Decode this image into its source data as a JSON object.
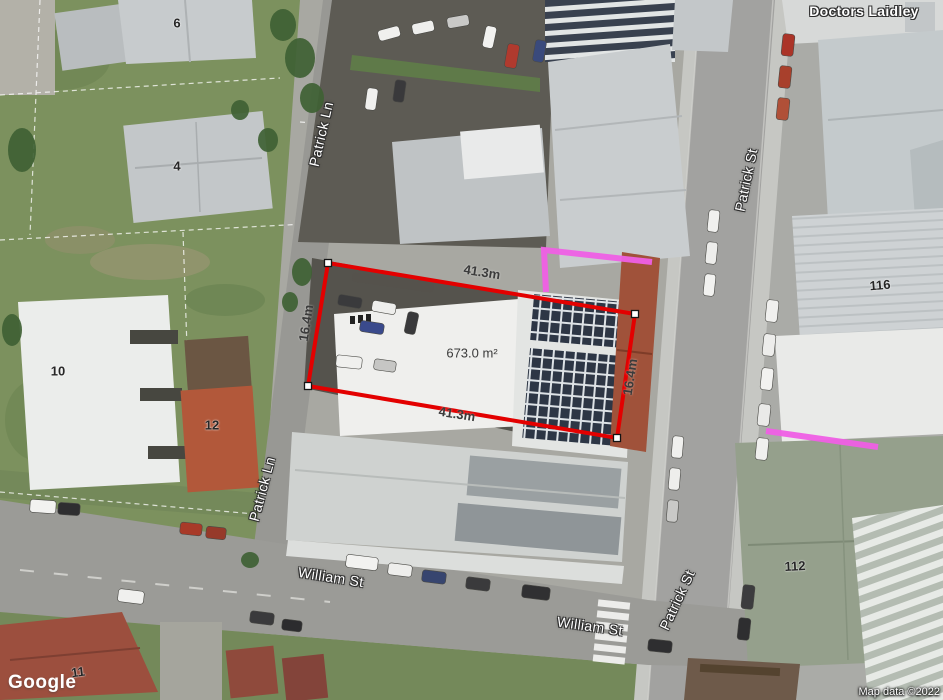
{
  "map": {
    "streets": {
      "patrick_ln_upper": "Patrick Ln",
      "patrick_ln_lower": "Patrick Ln",
      "patrick_st_upper": "Patrick St",
      "patrick_st_lower": "Patrick St",
      "william_st_west": "William St",
      "william_st_east": "William St"
    },
    "place": {
      "doctors_laidley": "Doctors Laidley"
    },
    "building_numbers": {
      "lot6": "6",
      "lot4": "4",
      "lot10": "10",
      "lot12": "12",
      "lot11": "11",
      "lot116": "116",
      "lot112": "112"
    }
  },
  "measurement": {
    "top_width": "41.3m",
    "bottom_width": "41.3m",
    "left_depth": "16.4m",
    "right_depth": "16.4m",
    "area": "673.0 m²",
    "outline_color": "#e30000",
    "vertex_color": "#ffffff",
    "highlight_color": "#ef5fe5",
    "polygon_points": "328,263 635,314 617,438 308,386",
    "highlight_line_1": "546,292 544,250 652,262",
    "highlight_line_2": "766,431 878,447"
  },
  "footer": {
    "logo": "Google",
    "attribution": "Map data ©2022"
  }
}
